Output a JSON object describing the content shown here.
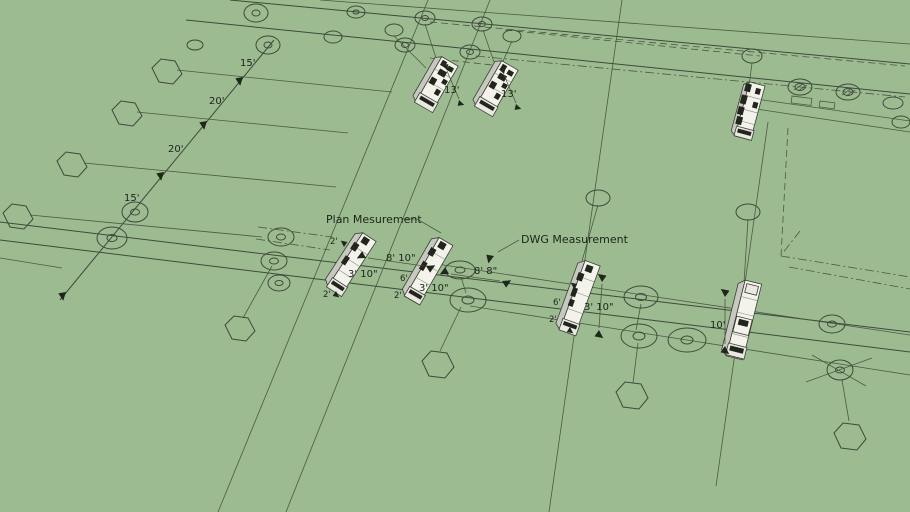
{
  "scene": {
    "background_color": "#9cbb90",
    "line_color": "#3f4a3c",
    "truck_fill": "#f3f3ec"
  },
  "callouts": {
    "plan_measurement": "Plan Mesurement",
    "dwg_measurement": "DWG Measurement"
  },
  "grid_dimensions": {
    "seg1": "15'",
    "seg2": "20'",
    "seg3": "20'",
    "seg4": "15'"
  },
  "truck_dimensions": {
    "top_truck_1_length": "13'",
    "top_truck_2_length": "13'",
    "gap_plan": "8' 10\"",
    "gap_dwg": "8' 8\"",
    "truck_a_width": "3' 10\"",
    "truck_b_width": "3' 10\"",
    "truck_c_width": "3' 10\"",
    "truck_d_length": "10'",
    "truck_a_front": "2'",
    "truck_a_rear": "2'",
    "truck_b_body": "6'",
    "truck_b_cab": "2'",
    "truck_c_body": "6'",
    "truck_c_cab": "2'"
  }
}
